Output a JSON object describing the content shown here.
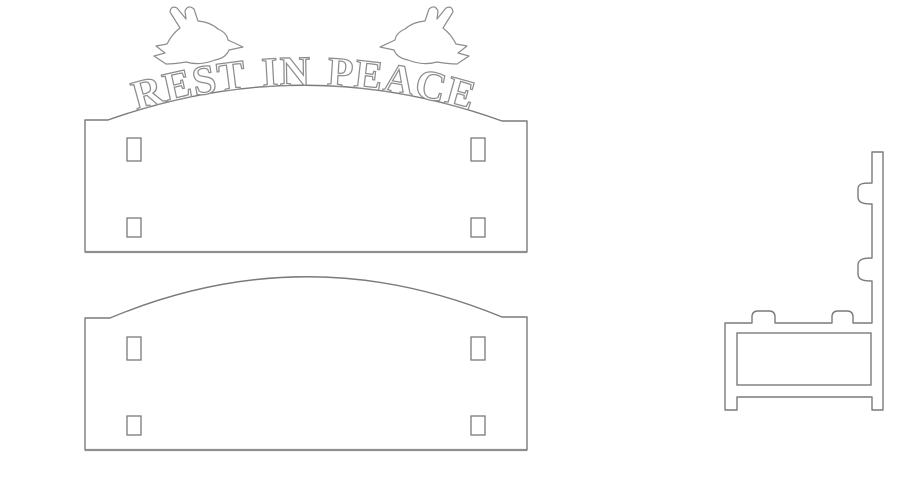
{
  "colors": {
    "background": "#ffffff",
    "panel_fill": "#ffffff",
    "outline": "#7a7a7a",
    "detail": "#8d8d8d",
    "bottom_edge": "#8f8f8f"
  },
  "engraving": {
    "text": "REST IN PEACE"
  },
  "icons": {
    "dove_left": "dove-left-icon",
    "dove_right": "dove-right-icon"
  },
  "parts": {
    "back_panel": {
      "slots": 4
    },
    "front_panel": {
      "slots": 4
    },
    "side_profile": {
      "windows": 1
    }
  }
}
